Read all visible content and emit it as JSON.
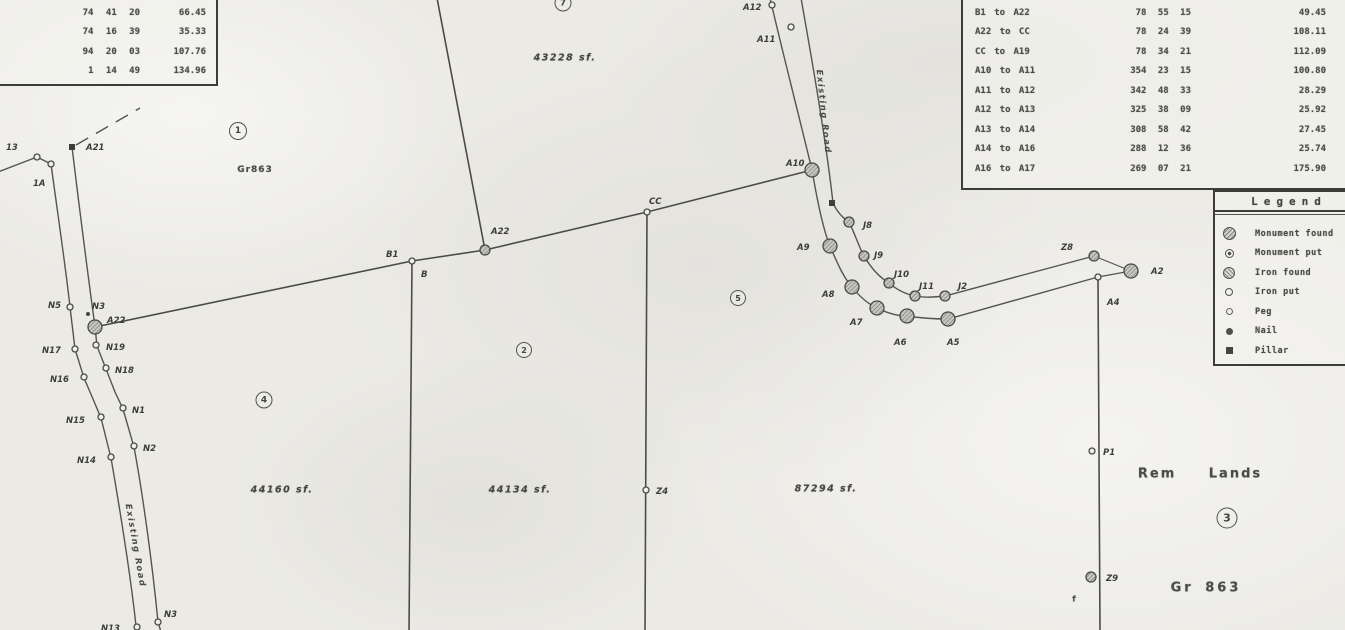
{
  "tables": {
    "top_left": {
      "rows": [
        {
          "bearing": "74 41 20",
          "dist": "66.45"
        },
        {
          "bearing": "74 16 39",
          "dist": "35.33"
        },
        {
          "bearing": "94 20 03",
          "dist": "107.76"
        },
        {
          "bearing": "1 14 49",
          "dist": "134.96"
        }
      ]
    },
    "top_right": {
      "rows": [
        {
          "course": "B1 to A22",
          "bearing": "78 55 15",
          "dist": "49.45"
        },
        {
          "course": "A22 to CC",
          "bearing": "78 24 39",
          "dist": "108.11"
        },
        {
          "course": "CC to A19",
          "bearing": "78 34 21",
          "dist": "112.09"
        },
        {
          "course": "A10 to A11",
          "bearing": "354 23 15",
          "dist": "100.80"
        },
        {
          "course": "A11 to A12",
          "bearing": "342 48 33",
          "dist": "28.29"
        },
        {
          "course": "A12 to A13",
          "bearing": "325 38 09",
          "dist": "25.92"
        },
        {
          "course": "A13 to A14",
          "bearing": "308 58 42",
          "dist": "27.45"
        },
        {
          "course": "A14 to A16",
          "bearing": "288 12 36",
          "dist": "25.74"
        },
        {
          "course": "A16 to A17",
          "bearing": "269 07 21",
          "dist": "175.90"
        }
      ]
    }
  },
  "legend": {
    "title": "Legend",
    "items": [
      {
        "symbol": "monument-found",
        "label": "Monument found"
      },
      {
        "symbol": "monument-put",
        "label": "Monument put"
      },
      {
        "symbol": "iron-found",
        "label": "Iron found"
      },
      {
        "symbol": "iron-put",
        "label": "Iron put"
      },
      {
        "symbol": "peg",
        "label": "Peg"
      },
      {
        "symbol": "nail",
        "label": "Nail"
      },
      {
        "symbol": "pillar",
        "label": "Pillar"
      }
    ]
  },
  "map": {
    "points": [
      {
        "label": "13",
        "marker": "small",
        "x": 37,
        "y": 157,
        "lx": 6,
        "ly": 150
      },
      {
        "label": "1A",
        "marker": "small",
        "x": 51,
        "y": 164,
        "lx": 33,
        "ly": 186
      },
      {
        "label": "A21",
        "marker": "square",
        "x": 72,
        "y": 147,
        "lx": 86,
        "ly": 150
      },
      {
        "label": "N5",
        "marker": "small",
        "x": 70,
        "y": 307,
        "lx": 48,
        "ly": 308
      },
      {
        "label": "N3",
        "marker": "dot",
        "x": 88,
        "y": 314,
        "lx": 92,
        "ly": 309
      },
      {
        "label": "A22",
        "marker": "big",
        "x": 95,
        "y": 327,
        "lx": 107,
        "ly": 323
      },
      {
        "label": "N17",
        "marker": "small",
        "x": 75,
        "y": 349,
        "lx": 42,
        "ly": 353
      },
      {
        "label": "N19",
        "marker": "small",
        "x": 96,
        "y": 345,
        "lx": 106,
        "ly": 350
      },
      {
        "label": "N18",
        "marker": "small",
        "x": 106,
        "y": 368,
        "lx": 115,
        "ly": 373
      },
      {
        "label": "N16",
        "marker": "small",
        "x": 84,
        "y": 377,
        "lx": 50,
        "ly": 382
      },
      {
        "label": "N1",
        "marker": "small",
        "x": 123,
        "y": 408,
        "lx": 132,
        "ly": 413
      },
      {
        "label": "N15",
        "marker": "small",
        "x": 101,
        "y": 417,
        "lx": 66,
        "ly": 423
      },
      {
        "label": "N2",
        "marker": "small",
        "x": 134,
        "y": 446,
        "lx": 143,
        "ly": 451
      },
      {
        "label": "N14",
        "marker": "small",
        "x": 111,
        "y": 457,
        "lx": 77,
        "ly": 463
      },
      {
        "label": "N13",
        "marker": "small",
        "x": 137,
        "y": 627,
        "lx": 101,
        "ly": 631
      },
      {
        "label": "N3",
        "marker": "small",
        "x": 158,
        "y": 622,
        "lx": 164,
        "ly": 617
      },
      {
        "label": "B1",
        "marker": "small",
        "x": 412,
        "y": 261,
        "lx": 386,
        "ly": 257
      },
      {
        "label": "B",
        "marker": "none",
        "lx": 421,
        "ly": 277
      },
      {
        "label": "A22",
        "marker": "mid",
        "x": 485,
        "y": 250,
        "lx": 491,
        "ly": 234
      },
      {
        "label": "CC",
        "marker": "small",
        "x": 647,
        "y": 212,
        "lx": 649,
        "ly": 204
      },
      {
        "label": "Z4",
        "marker": "small",
        "x": 646,
        "y": 490,
        "lx": 656,
        "ly": 494
      },
      {
        "label": "A12",
        "marker": "small",
        "x": 772,
        "y": 5,
        "lx": 743,
        "ly": 10
      },
      {
        "label": "A11",
        "marker": "small",
        "x": 791,
        "y": 27,
        "lx": 757,
        "ly": 42
      },
      {
        "label": "A10",
        "marker": "big",
        "x": 812,
        "y": 170,
        "lx": 786,
        "ly": 166
      },
      {
        "label": "",
        "marker": "square",
        "x": 832,
        "y": 203
      },
      {
        "label": "J8",
        "marker": "mid",
        "x": 849,
        "y": 222,
        "lx": 863,
        "ly": 228
      },
      {
        "label": "A9",
        "marker": "big",
        "x": 830,
        "y": 246,
        "lx": 797,
        "ly": 250
      },
      {
        "label": "J9",
        "marker": "mid",
        "x": 864,
        "y": 256,
        "lx": 874,
        "ly": 258
      },
      {
        "label": "J10",
        "marker": "mid",
        "x": 889,
        "y": 283,
        "lx": 894,
        "ly": 277
      },
      {
        "label": "J11",
        "marker": "mid",
        "x": 915,
        "y": 296,
        "lx": 919,
        "ly": 289
      },
      {
        "label": "J2",
        "marker": "mid",
        "x": 945,
        "y": 296,
        "lx": 958,
        "ly": 289
      },
      {
        "label": "A8",
        "marker": "big",
        "x": 852,
        "y": 287,
        "lx": 822,
        "ly": 297
      },
      {
        "label": "A7",
        "marker": "big",
        "x": 877,
        "y": 308,
        "lx": 850,
        "ly": 325
      },
      {
        "label": "A6",
        "marker": "big",
        "x": 907,
        "y": 316,
        "lx": 894,
        "ly": 345
      },
      {
        "label": "A5",
        "marker": "big",
        "x": 948,
        "y": 319,
        "lx": 947,
        "ly": 345
      },
      {
        "label": "Z8",
        "marker": "mid",
        "x": 1094,
        "y": 256,
        "lx": 1061,
        "ly": 250
      },
      {
        "label": "A2",
        "marker": "big",
        "x": 1131,
        "y": 271,
        "lx": 1151,
        "ly": 274
      },
      {
        "label": "A4",
        "marker": "small",
        "x": 1098,
        "y": 277,
        "lx": 1107,
        "ly": 305
      },
      {
        "label": "P1",
        "marker": "small",
        "x": 1092,
        "y": 451,
        "lx": 1103,
        "ly": 455
      },
      {
        "label": "Z9",
        "marker": "mid",
        "x": 1091,
        "y": 577,
        "lx": 1106,
        "ly": 581
      }
    ],
    "area_labels": [
      {
        "text": "43228 sf.",
        "x": 565,
        "y": 58
      },
      {
        "text": "44160 sf.",
        "x": 282,
        "y": 490
      },
      {
        "text": "44134 sf.",
        "x": 520,
        "y": 490
      },
      {
        "text": "87294 sf.",
        "x": 826,
        "y": 489
      }
    ],
    "parcel_numbers": [
      {
        "num": "1",
        "x": 238,
        "y": 131,
        "d": 16
      },
      {
        "num": "7",
        "x": 563,
        "y": 3,
        "d": 15
      },
      {
        "num": "2",
        "x": 524,
        "y": 350,
        "d": 14
      },
      {
        "num": "4",
        "x": 264,
        "y": 400,
        "d": 15
      },
      {
        "num": "5",
        "x": 738,
        "y": 298,
        "d": 14
      },
      {
        "num": "3",
        "x": 1227,
        "y": 518,
        "d": 19
      }
    ],
    "text_labels": [
      {
        "text": "Gr863",
        "x": 255,
        "y": 170,
        "size": 9,
        "ls": 1,
        "ws": 0
      },
      {
        "text": "Gr 863",
        "x": 1206,
        "y": 588,
        "size": 13,
        "ls": 3,
        "ws": 4
      },
      {
        "text": "Rem Lands",
        "x": 1200,
        "y": 474,
        "size": 13,
        "ls": 2,
        "ws": 26
      },
      {
        "text": "f",
        "x": 1074,
        "y": 599,
        "size": 8,
        "ls": 0,
        "ws": 0
      }
    ],
    "road_labels": [
      {
        "text": "Existing Road",
        "x": 133,
        "y": 546,
        "rotate": 80
      },
      {
        "text": "Existing Road",
        "x": 821,
        "y": 112,
        "rotate": 84
      }
    ]
  }
}
